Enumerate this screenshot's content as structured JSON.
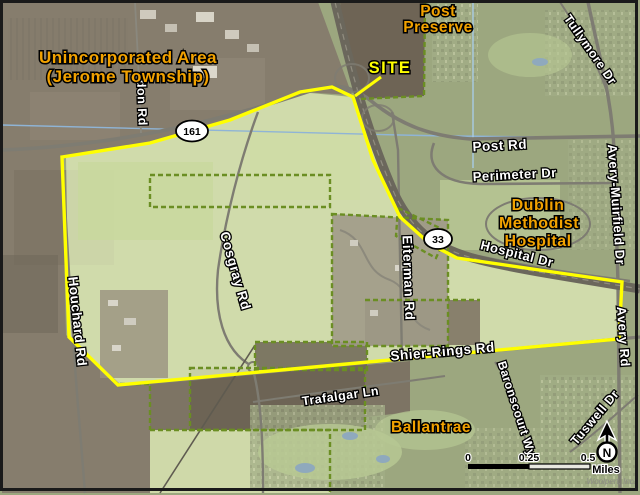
{
  "map": {
    "title_hint": "Aerial site-location map, Dublin Ohio area",
    "area_labels": {
      "unincorporated_line1": "Unincorporated Area",
      "unincorporated_line2": "(Jerome Township)",
      "post_preserve_line1": "Post",
      "post_preserve_line2": "Preserve",
      "hospital_line1": "Dublin",
      "hospital_line2": "Methodist",
      "hospital_line3": "Hospital",
      "ballantrae": "Ballantrae",
      "site": "SITE"
    },
    "road_labels": {
      "post_rd": "Post Rd",
      "perimeter_dr": "Perimeter Dr",
      "hospital_dr": "Hospital Dr",
      "avery_muirfield_dr": "Avery-Muirfield Dr",
      "avery_rd": "Avery Rd",
      "tullymore_dr": "Tullymore Dr",
      "tuswell_dr": "Tuswell Dr",
      "baronscourt_wy": "Baronscourt Wy",
      "shier_rings_rd": "Shier-Rings Rd",
      "trafalgar_ln": "Trafalgar Ln",
      "cosgray_rd": "Cosgray Rd",
      "eiterman_rd": "Eiterman Rd",
      "houchard_rd": "Houchard Rd",
      "north_partial_rd": "don Rd"
    },
    "route_shields": {
      "sr161": "161",
      "us33": "33"
    },
    "scale_bar": {
      "tick0": "0",
      "tick1": "0.25",
      "tick2": "0.5",
      "units": "Miles"
    },
    "north_arrow": {
      "label": "N"
    },
    "credit": "Woolpert, Inc.",
    "colors": {
      "site_boundary": "#FFFF00",
      "area_label_text": "#F2A200",
      "road_label_text": "#FFFFFF",
      "parcel_dash": "#6B8E23",
      "site_fill": "#DCE6B4"
    }
  }
}
